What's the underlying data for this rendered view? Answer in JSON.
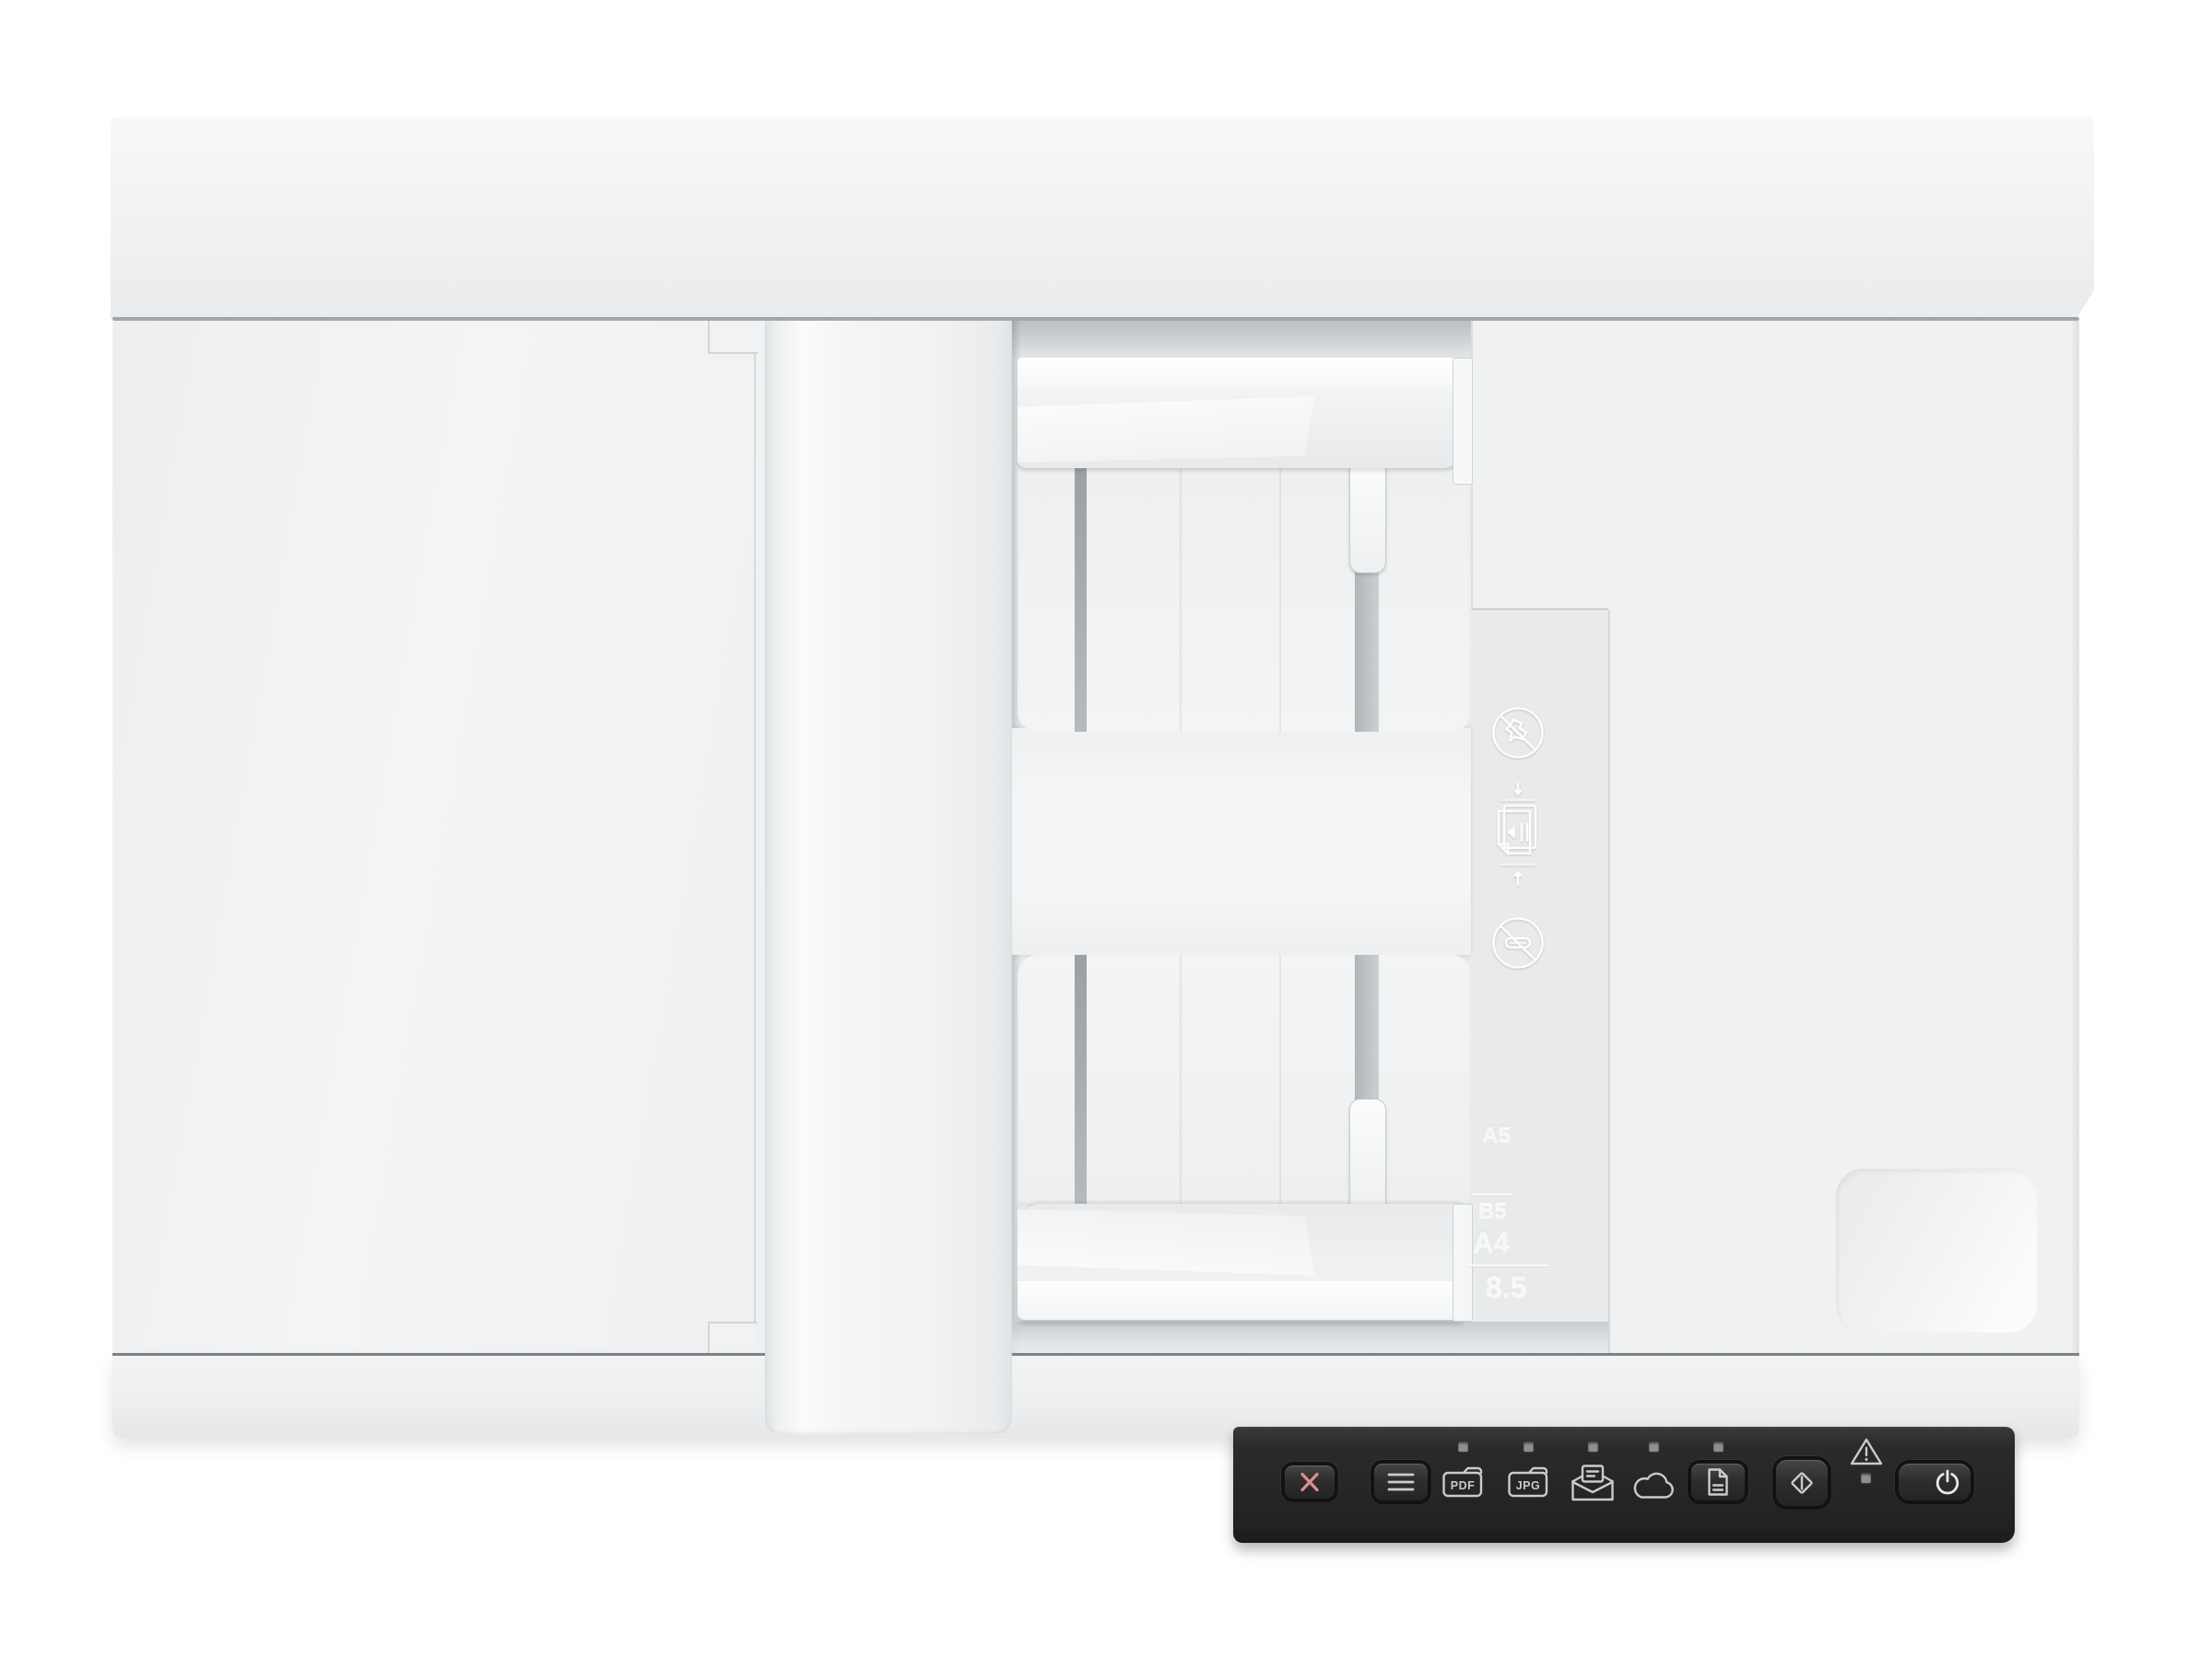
{
  "title": "Flatbed document scanner with ADF - top view",
  "tray": {
    "paper_size_markings": {
      "a5": "A5",
      "b5": "B5",
      "a4": "A4",
      "letter_width": "8.5"
    },
    "embossed_icons": [
      {
        "name": "no-wrinkled-paper-icon"
      },
      {
        "name": "paper-stack-alignment-icon"
      },
      {
        "name": "no-paperclips-icon"
      }
    ]
  },
  "control_panel": {
    "buttons": [
      {
        "id": "cancel",
        "icon": "x-cancel-icon",
        "has_led": false
      },
      {
        "id": "menu",
        "icon": "menu-lines-icon",
        "has_led": false
      },
      {
        "id": "scan-to-pdf",
        "label": "PDF",
        "icon": "pdf-file-icon",
        "has_led": true
      },
      {
        "id": "scan-to-jpg",
        "label": "JPG",
        "icon": "jpg-file-icon",
        "has_led": true
      },
      {
        "id": "scan-to-email",
        "icon": "email-envelope-icon",
        "has_led": true
      },
      {
        "id": "scan-to-cloud",
        "icon": "cloud-icon",
        "has_led": true
      },
      {
        "id": "document-feed",
        "icon": "document-icon",
        "has_led": true
      },
      {
        "id": "start-scan",
        "icon": "start-scan-diamond-icon",
        "has_led": false
      },
      {
        "id": "error-indicator",
        "icon": "warning-triangle-icon",
        "has_led": true
      },
      {
        "id": "power",
        "icon": "power-icon",
        "has_led": false
      }
    ]
  },
  "colors": {
    "panel_bg": "#2a2a2a",
    "cancel_x": "#d98f8f",
    "glyph": "#c9cbcc",
    "led": "#8f8f8f",
    "device_white": "#eef0f1"
  }
}
